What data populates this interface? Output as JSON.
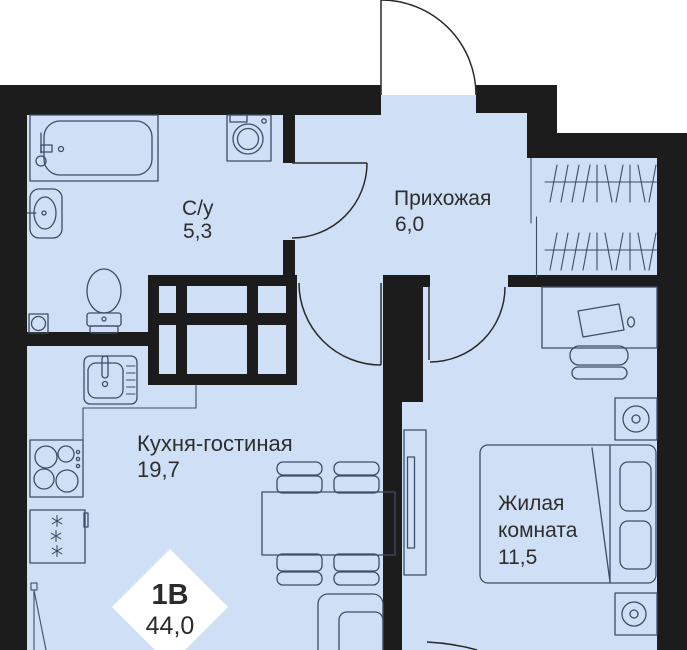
{
  "plan": {
    "unit_label": "1В",
    "total_area": "44,0",
    "rooms": [
      {
        "name": "С/у",
        "area": "5,3"
      },
      {
        "name": "Прихожая",
        "area": "6,0"
      },
      {
        "name": "Кухня-гостиная",
        "area": "19,7"
      },
      {
        "name": "Жилая комната",
        "area": "11,5",
        "lines": [
          "Жилая",
          "комната"
        ]
      }
    ],
    "furniture_icons": [
      "bathtub-icon",
      "washing-machine-icon",
      "wall-sink-icon",
      "toilet-icon",
      "floor-drain-icon",
      "kitchen-sink-icon",
      "stove-icon",
      "fridge-icon",
      "dining-table-icon",
      "chair-icon",
      "sofa-icon",
      "tv-console-icon",
      "wardrobe-hangers-icon",
      "desk-icon",
      "laptop-icon",
      "desk-chair-icon",
      "nightstand-lamp-icon",
      "double-bed-icon",
      "pillow-icon",
      "door-swing-icon"
    ],
    "colors": {
      "floor": "#cfe0f6",
      "wall": "#1c1c1c",
      "furniture_outline": "#3e4d68",
      "label_text": "#2e2e2e",
      "background": "#ffffff",
      "badge_background": "#ffffff"
    }
  }
}
